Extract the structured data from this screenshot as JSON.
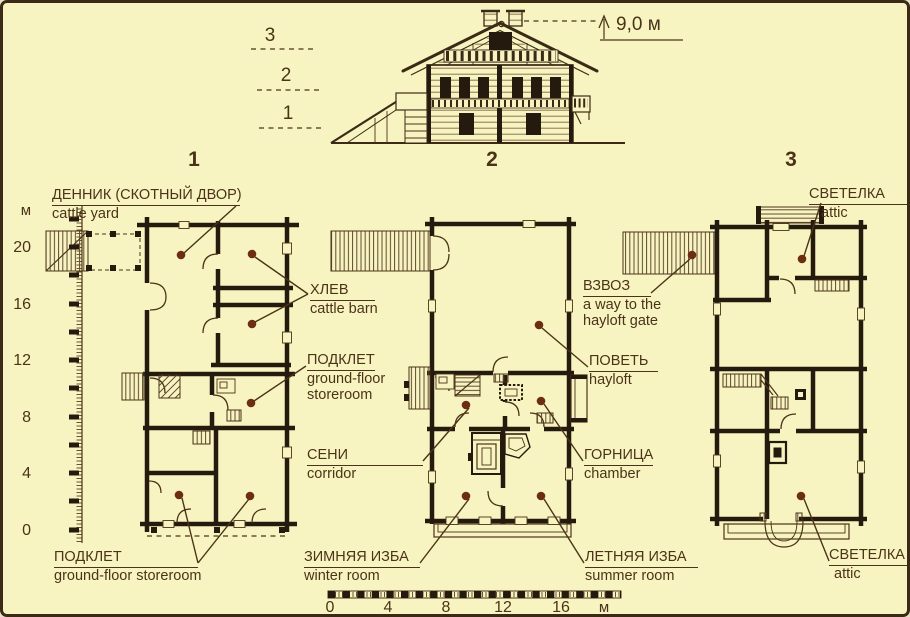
{
  "background_color": "#f8f4c1",
  "accent_colors": {
    "line": "#4a3318",
    "wall": "#241a0d",
    "dot": "#6b2e12"
  },
  "elevation": {
    "height_label": "9,0 м",
    "levels": [
      "3",
      "2",
      "1"
    ]
  },
  "plan_numbers": [
    "1",
    "2",
    "3"
  ],
  "callouts": {
    "dennik": {
      "ru": "ДЕННИК (СКОТНЫЙ ДВОР)",
      "en": "cattle yard"
    },
    "khlev": {
      "ru": "ХЛЕВ",
      "en": "cattle barn"
    },
    "podklet_mid": {
      "ru": "ПОДКЛЕТ",
      "en_line1": "ground-floor",
      "en_line2": "storeroom"
    },
    "seni": {
      "ru": "СЕНИ",
      "en": "corridor"
    },
    "zimnyaya_izba": {
      "ru": "ЗИМНЯЯ ИЗБА",
      "en": "winter room"
    },
    "podklet_bottom": {
      "ru": "ПОДКЛЕТ",
      "en": "ground-floor storeroom"
    },
    "vzvoz": {
      "ru": "ВЗВОЗ",
      "en_line1": "a way to the",
      "en_line2": "hayloft gate"
    },
    "povet": {
      "ru": "ПОВЕТЬ",
      "en": "hayloft"
    },
    "gornitsa": {
      "ru": "ГОРНИЦА",
      "en": "chamber"
    },
    "letnyaya_izba": {
      "ru": "ЛЕТНЯЯ ИЗБА",
      "en": "summer room"
    },
    "svetelka_top": {
      "ru": "СВЕТЕЛКА",
      "en": "attic"
    },
    "svetelka_bottom": {
      "ru": "СВЕТЕЛКА",
      "en": "attic"
    }
  },
  "vertical_scale": {
    "unit": "м",
    "ticks": [
      "20",
      "16",
      "12",
      "8",
      "4",
      "0"
    ]
  },
  "horizontal_scale": {
    "ticks": [
      "0",
      "4",
      "8",
      "12",
      "16"
    ],
    "unit": "м"
  }
}
